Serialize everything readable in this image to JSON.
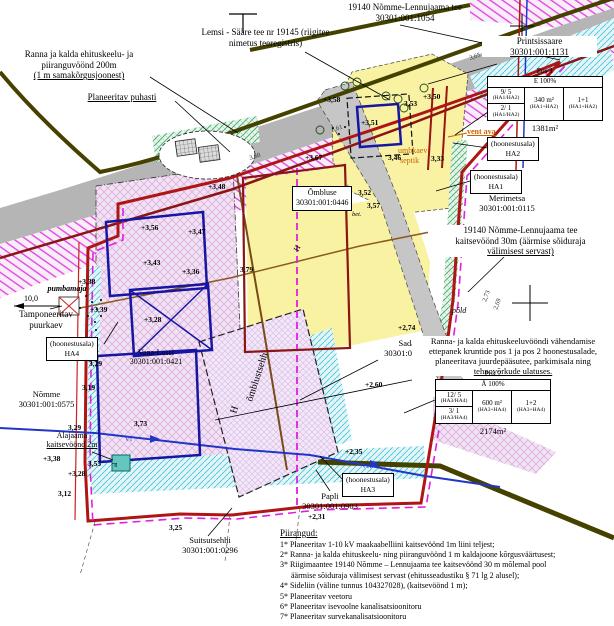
{
  "colors": {
    "boundary_red": "#b01515",
    "magenta": "#e020e0",
    "road_grey": "#b5b5b5",
    "olive": "#454200",
    "yellow": "#f8f2a2",
    "lavender": "#f1e3f4",
    "cyan_line": "#4ec4d8",
    "green_line": "#4aa86e",
    "building_blue": "#1616a3",
    "water_blue": "#2136c9",
    "cable_red": "#cc2222",
    "label_orange": "#c96300"
  },
  "labels": {
    "road_main": {
      "l1": "19140 Nõmme-Lennujaama tee",
      "l2": "30301:001:1054"
    },
    "lemsi": {
      "l1": "Lemsi - Sääre tee nr 19145 (riigitee",
      "l2": "nimetus teeregistris)"
    },
    "ranna200": {
      "l1": "Ranna ja kalda ehituskeelu- ja",
      "l2": "piiranguvöönd 200m",
      "l3": "(1 m samakõrgusjoonest)"
    },
    "puhasti": "Planeeritav puhasti",
    "printsissaare": {
      "l1": "Printsissaare",
      "l2": "30301:001:1131"
    },
    "vent_ava": "vent ava",
    "umbkaev": "umbkaev",
    "septik": "septik",
    "merimetsa": {
      "l1": "Merimetsa",
      "l2": "30301:001:0115"
    },
    "kaitse30": {
      "l1": "19140 Nõmme-Lennujaama tee",
      "l2": "kaitsevöönd 30m (äärmise sõiduraja",
      "l3": "välimisest servast)"
    },
    "ombluse": {
      "l1": "Õmbluse",
      "l2": "30301:001:0446"
    },
    "pold": "põld",
    "sadama": {
      "l1": "Sadama",
      "l2": "30301:001:0093"
    },
    "vahendamine": {
      "l1": "Ranna- ja kalda ehituskeeluvööndi vähendamise",
      "l2": "ettepanek kruntide pos 1 ja pos 2 hoonestusalade,",
      "l3": "planeeritava juurdepääsutee, parkimisala ning",
      "l4": "tehnovõrkude ulatuses."
    },
    "pumbamaja": "pumbamaja",
    "dist": "10,0",
    "tamponeeritav": {
      "l1": "Tamponeeritav",
      "l2": "puurkaev"
    },
    "vana_lossi": {
      "l1": "Vana-Lossi",
      "l2": "30301:001:0421"
    },
    "nomme": {
      "l1": "Nõmme",
      "l2": "30301:001:0575"
    },
    "alajaam": {
      "l1": "Alajaama",
      "l2": "kaitsevöönd 2m"
    },
    "suitsutsehh": {
      "l1": "Suitsutsehhi",
      "l2": "30301:001:0296"
    },
    "papli": {
      "l1": "Papli",
      "l2": "30301:001:0903"
    },
    "hoonestusala": "(hoonestusala)",
    "ha1": "HA1",
    "ha2": "HA2",
    "ha3": "HA3",
    "ha4": "HA4"
  },
  "tables": {
    "pos1": {
      "title": "Pos 1",
      "header": "E 100%",
      "r1c1": "9/ 5",
      "r1c1b": "(HA1/HA2)",
      "r2c1": "2/ 1",
      "r2c1b": "(HA1/HA2)",
      "c2": "340 m²",
      "c2b": "(HA1+HA2)",
      "c3": "1+1",
      "c3b": "(HA1+HA2)",
      "area": "1381m²"
    },
    "pos2": {
      "title": "Pos 2",
      "header": "Ä 100%",
      "r1c1": "12/ 5",
      "r1c1b": "(HA3/HA4)",
      "r2c1": "3/ 1",
      "r2c1b": "(HA3/HA4)",
      "c2": "600 m²",
      "c2b": "(HA3+HA4)",
      "c3": "1+2",
      "c3b": "(HA3+HA4)",
      "area": "2174m²"
    }
  },
  "legend": {
    "title": "Piirangud:",
    "items": [
      "1* Planeeritav 1-10 kV maakaabelliini kaitsevöönd 1m liini teljest;",
      "2* Ranna- ja kalda ehituskeelu- ning piiranguvöönd 1 m kaldajoone kõrgusväärtusest;",
      "3* Riigimaantee 19140 Nõmme – Lennujaama tee kaitsevöönd 30 m mõlemal pool",
      "äärmise sõiduraja välimisest servast (ehitusseadustiku § 71 lg 2 alusel);",
      "4* Sideliin (väline tunnus 104327028), (kaitsevöönd 1 m);",
      "5* Planeeritav veetoru",
      "6* Planeeritav isevoolne kanalisatsioonitoru",
      "7* Planeeritav survekanalisatsioonitoru"
    ]
  },
  "elev": [
    "+3,58",
    "+3,51",
    "3,53",
    "+3,50",
    "3,52",
    "3,57",
    "+3,47",
    "+3,56",
    "+3,43",
    "+3,36",
    "+3,28",
    "+3,38",
    "+3,39",
    "3,29",
    "3,19",
    "3,29",
    "+3,38",
    "3,55",
    "+3,28",
    "3,12",
    "3,73",
    "3,25",
    "+2,74",
    "+2,60",
    "+2,35",
    "+2,31",
    "3,79",
    "+3,48",
    "+3,67",
    "3,46",
    "3,33"
  ],
  "misc": {
    "omblustsehh": "õmblustsehh",
    "h": "H",
    "al": "al",
    "v1": "V1",
    "bet": "bet.",
    "rm": [
      "3,68",
      "3,61",
      "3,65",
      "2,73",
      "2,69"
    ]
  }
}
